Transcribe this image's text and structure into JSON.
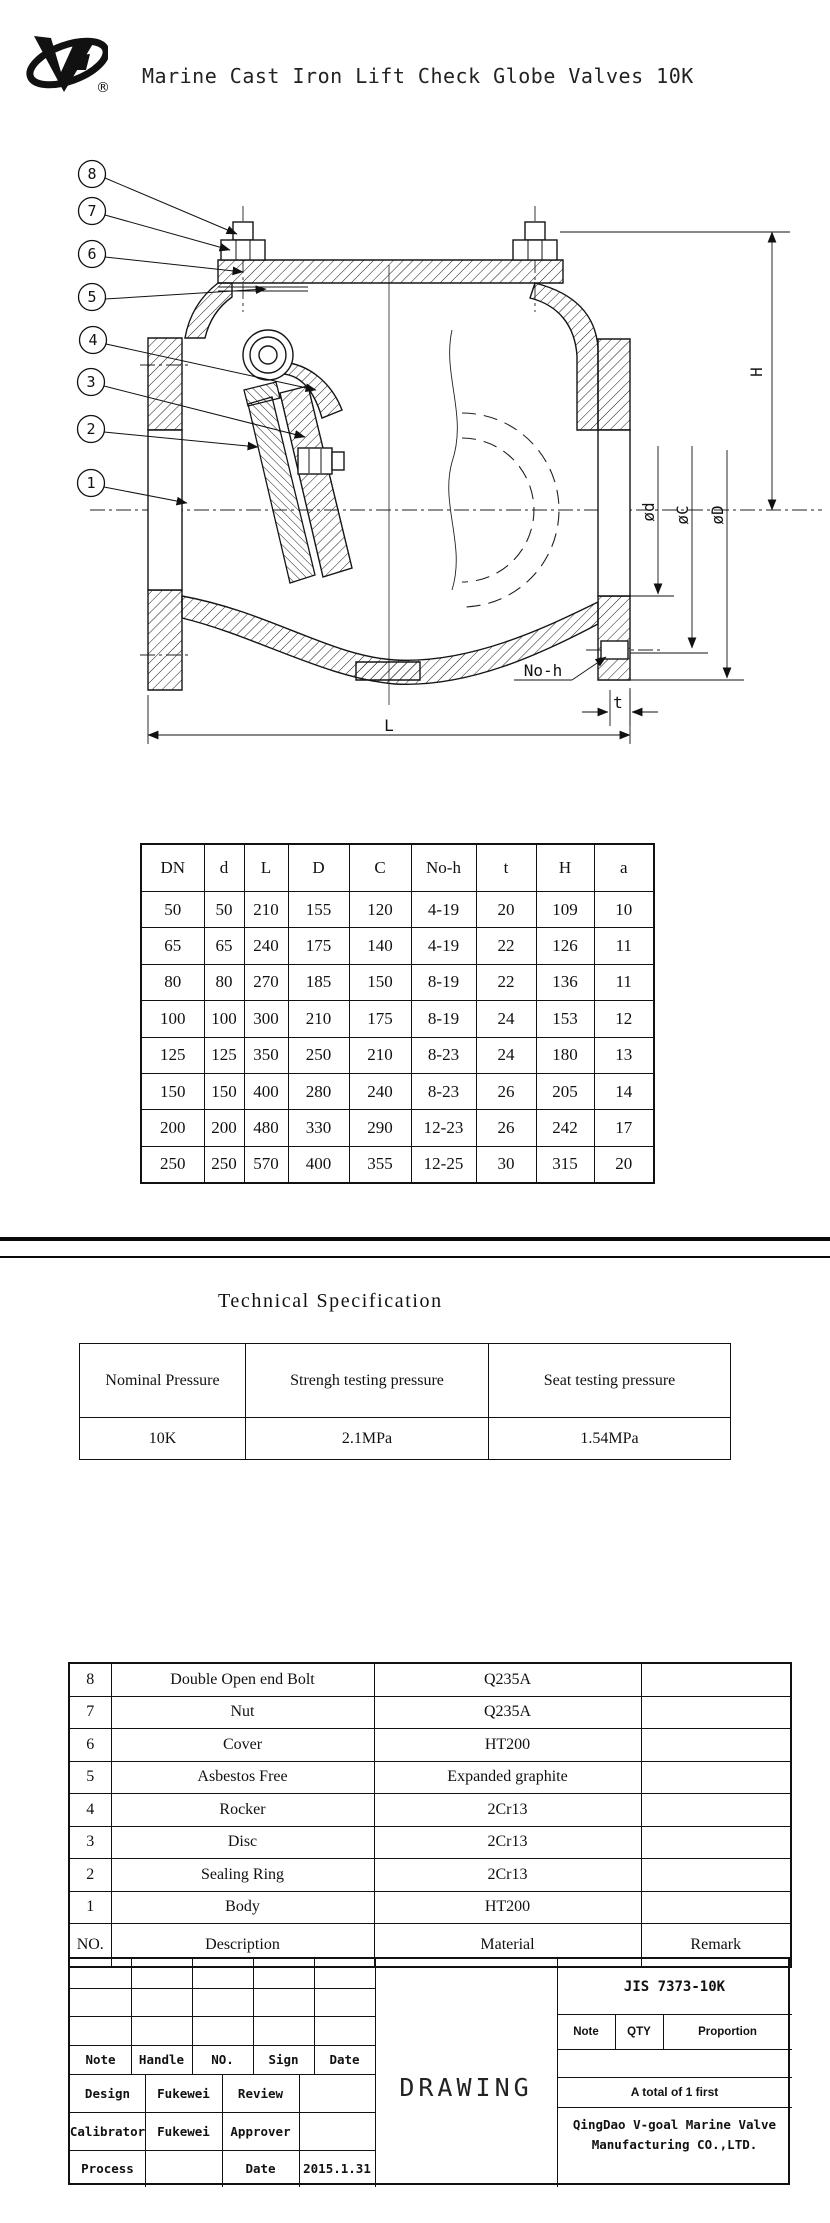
{
  "header": {
    "title": "Marine Cast Iron Lift Check Globe Valves 10K",
    "registered_mark": "®"
  },
  "drawing": {
    "callouts": [
      "8",
      "7",
      "6",
      "5",
      "4",
      "3",
      "2",
      "1"
    ],
    "dims": {
      "H": "H",
      "d": "ød",
      "C": "øC",
      "D": "øD",
      "no_h": "No-h",
      "t": "t",
      "L": "L"
    }
  },
  "dimension_table": {
    "headers": [
      "DN",
      "d",
      "L",
      "D",
      "C",
      "No-h",
      "t",
      "H",
      "a"
    ],
    "rows": [
      [
        "50",
        "50",
        "210",
        "155",
        "120",
        "4-19",
        "20",
        "109",
        "10"
      ],
      [
        "65",
        "65",
        "240",
        "175",
        "140",
        "4-19",
        "22",
        "126",
        "11"
      ],
      [
        "80",
        "80",
        "270",
        "185",
        "150",
        "8-19",
        "22",
        "136",
        "11"
      ],
      [
        "100",
        "100",
        "300",
        "210",
        "175",
        "8-19",
        "24",
        "153",
        "12"
      ],
      [
        "125",
        "125",
        "350",
        "250",
        "210",
        "8-23",
        "24",
        "180",
        "13"
      ],
      [
        "150",
        "150",
        "400",
        "280",
        "240",
        "8-23",
        "26",
        "205",
        "14"
      ],
      [
        "200",
        "200",
        "480",
        "330",
        "290",
        "12-23",
        "26",
        "242",
        "17"
      ],
      [
        "250",
        "250",
        "570",
        "400",
        "355",
        "12-25",
        "30",
        "315",
        "20"
      ]
    ]
  },
  "technical_specification": {
    "title": "Technical Specification",
    "headers": [
      "Nominal Pressure",
      "Strengh testing pressure",
      "Seat testing pressure"
    ],
    "values": [
      "10K",
      "2.1MPa",
      "1.54MPa"
    ]
  },
  "parts_list": {
    "rows": [
      {
        "no": "8",
        "description": "Double Open end Bolt",
        "material": "Q235A",
        "remark": ""
      },
      {
        "no": "7",
        "description": "Nut",
        "material": "Q235A",
        "remark": ""
      },
      {
        "no": "6",
        "description": "Cover",
        "material": "HT200",
        "remark": ""
      },
      {
        "no": "5",
        "description": "Asbestos Free",
        "material": "Expanded graphite",
        "remark": ""
      },
      {
        "no": "4",
        "description": "Rocker",
        "material": "2Cr13",
        "remark": ""
      },
      {
        "no": "3",
        "description": "Disc",
        "material": "2Cr13",
        "remark": ""
      },
      {
        "no": "2",
        "description": "Sealing Ring",
        "material": "2Cr13",
        "remark": ""
      },
      {
        "no": "1",
        "description": "Body",
        "material": "HT200",
        "remark": ""
      }
    ],
    "header_row": {
      "no": "NO.",
      "description": "Description",
      "material": "Material",
      "remark": "Remark"
    }
  },
  "title_block": {
    "grid_headers": [
      "Note",
      "Handle",
      "NO.",
      "Sign",
      "Date"
    ],
    "sign_rows": [
      {
        "label_a": "Design",
        "value_a": "Fukewei",
        "label_b": "Review",
        "value_b": ""
      },
      {
        "label_a": "Calibrator",
        "value_a": "Fukewei",
        "label_b": "Approver",
        "value_b": ""
      },
      {
        "label_a": "Process",
        "value_a": "",
        "label_b": "Date",
        "value_b": "2015.1.31"
      }
    ],
    "drawing_label": "DRAWING",
    "standard_code": "JIS 7373-10K",
    "ratio_headers": [
      "Note",
      "QTY",
      "Proportion"
    ],
    "total_note": "A total of 1 first",
    "company": [
      "QingDao V-goal Marine Valve",
      "Manufacturing CO.,LTD."
    ]
  },
  "colors": {
    "ink": "#111111",
    "paper": "#ffffff"
  }
}
